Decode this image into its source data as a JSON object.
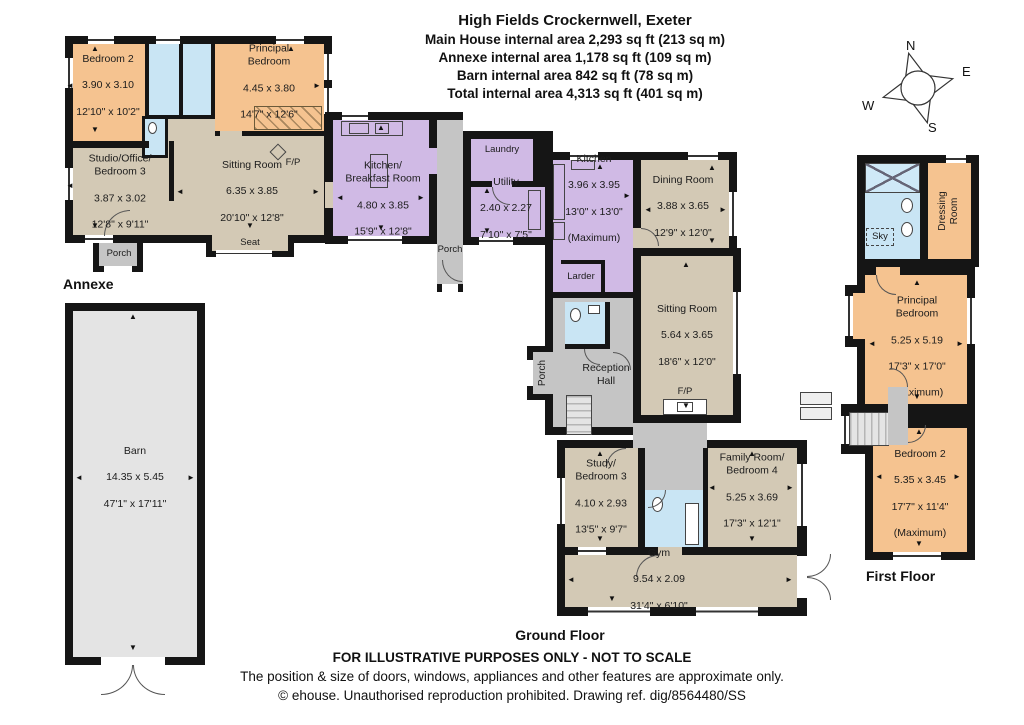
{
  "title": {
    "line1": "High Fields Crockernwell, Exeter",
    "line2": "Main House internal area 2,293 sq ft (213 sq m)",
    "line3": "Annexe internal area 1,178 sq ft (109 sq m)",
    "line4": "Barn internal area 842 sq ft (78 sq m)",
    "line5": "Total internal area 4,313 sq ft (401 sq m)"
  },
  "compass": {
    "n": "N",
    "e": "E",
    "s": "S",
    "w": "W"
  },
  "floors": {
    "annexe": "Annexe",
    "ground": "Ground Floor",
    "first": "First Floor"
  },
  "labels": {
    "fp": "F/P",
    "seat": "Seat",
    "porch": "Porch",
    "laundry": "Laundry",
    "larder": "Larder",
    "reception": "Reception\nHall",
    "dressing": "Dressing\nRoom",
    "sky": "Sky"
  },
  "rooms": {
    "annexe_bedroom2": {
      "name": "Bedroom 2",
      "metric": "3.90 x 3.10",
      "imperial": "12'10\" x 10'2\""
    },
    "annexe_principal": {
      "name": "Principal\nBedroom",
      "metric": "4.45 x 3.80",
      "imperial": "14'7\" x 12'6\""
    },
    "annexe_studio": {
      "name": "Studio/Office/\nBedroom 3",
      "metric": "3.87 x 3.02",
      "imperial": "12'8\" x 9'11\""
    },
    "annexe_sitting": {
      "name": "Sitting Room",
      "metric": "6.35 x 3.85",
      "imperial": "20'10\" x 12'8\""
    },
    "kitchen_breakfast": {
      "name": "Kitchen/\nBreakfast Room",
      "metric": "4.80 x 3.85",
      "imperial": "15'9\" x 12'8\""
    },
    "utility": {
      "name": "Utility",
      "metric": "2.40 x 2.27",
      "imperial": "7'10\" x 7'5\""
    },
    "kitchen": {
      "name": "Kitchen",
      "metric": "3.96 x 3.95",
      "imperial": "13'0\" x 13'0\"",
      "note": "(Maximum)"
    },
    "dining": {
      "name": "Dining Room",
      "metric": "3.88 x 3.65",
      "imperial": "12'9\" x 12'0\""
    },
    "sitting": {
      "name": "Sitting Room",
      "metric": "5.64 x 3.65",
      "imperial": "18'6\" x 12'0\""
    },
    "study": {
      "name": "Study/\nBedroom 3",
      "metric": "4.10 x 2.93",
      "imperial": "13'5\" x 9'7\""
    },
    "family": {
      "name": "Family Room/\nBedroom 4",
      "metric": "5.25 x 3.69",
      "imperial": "17'3\" x 12'1\""
    },
    "gym": {
      "name": "Gym",
      "metric": "9.54 x 2.09",
      "imperial": "31'4\" x 6'10\""
    },
    "barn": {
      "name": "Barn",
      "metric": "14.35 x 5.45",
      "imperial": "47'1\" x 17'11\""
    },
    "ff_principal": {
      "name": "Principal\nBedroom",
      "metric": "5.25 x 5.19",
      "imperial": "17'3\" x 17'0\"",
      "note": "(Maximum)"
    },
    "ff_bedroom2": {
      "name": "Bedroom 2",
      "metric": "5.35 x 3.45",
      "imperial": "17'7\" x 11'4\"",
      "note": "(Maximum)"
    }
  },
  "footer": {
    "line1": "FOR ILLUSTRATIVE PURPOSES ONLY - NOT TO SCALE",
    "line2": "The position & size of doors, windows, appliances and other features are approximate only.",
    "line3": "© ehouse. Unauthorised reproduction prohibited. Drawing ref. dig/8564480/SS"
  },
  "icons": {
    "u": "▲",
    "d": "▼",
    "l": "◄",
    "r": "►"
  },
  "colors": {
    "bedroom_fill": "#f5c390",
    "living_fill": "#d3c9b5",
    "kitchen_fill": "#d0bae5",
    "bathroom_fill": "#c9e5f4",
    "circulation_fill": "#c5c5c5",
    "barn_fill": "#e4e4e4",
    "wall": "#151515"
  }
}
